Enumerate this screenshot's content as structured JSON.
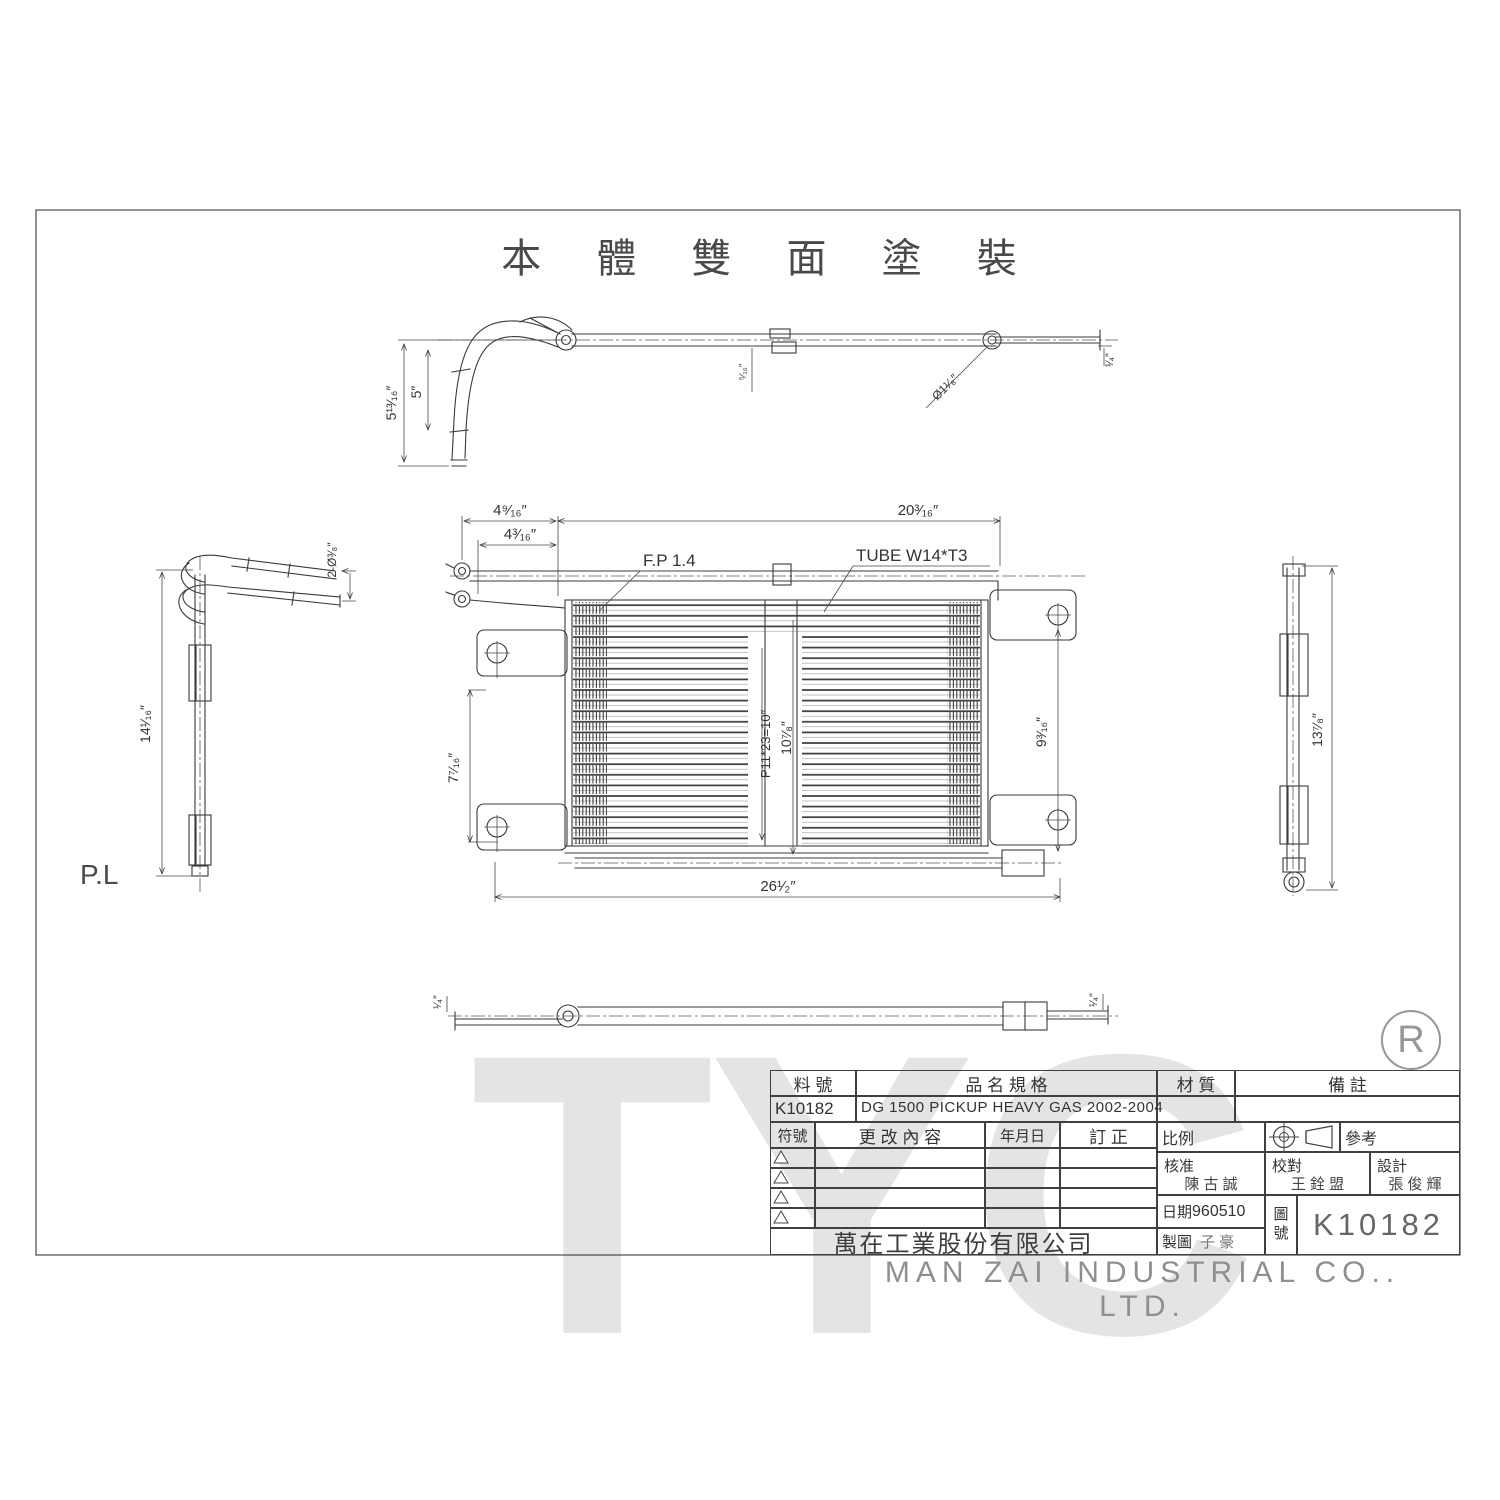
{
  "title": "本 體 雙 面 塗 裝",
  "watermark": "TYC",
  "registered": "R",
  "labels": {
    "pl": "P.L",
    "fin_pitch": "F.P 1.4",
    "tube_spec": "TUBE W14*T3"
  },
  "dims": {
    "top": {
      "overall_drop": "5¹³⁄₁₆″",
      "inner_drop": "5″",
      "clamp": "⁵⁄₁₆″",
      "hole": "Ø1¹⁄₈″",
      "tube_end": "¹⁄₄″"
    },
    "left": {
      "holes": "2-Ø³⁄₈″",
      "height": "14¹⁄₁₆″"
    },
    "front": {
      "offset_outer": "4⁹⁄₁₆″",
      "offset_inner": "4³⁄₁₆″",
      "core_width": "20³⁄₁₆″",
      "tube_pitch": "P11*23=10″",
      "core_height": "10⁷⁄₈″",
      "left_height": "7⁷⁄₁₆″",
      "right_height": "9³⁄₁₆″",
      "overall_width": "26¹⁄₂″"
    },
    "right": {
      "height": "13⁷⁄₈″"
    },
    "bottom": {
      "left_end": "¹⁄₄″",
      "right_end": "¹⁄₄″"
    }
  },
  "title_block": {
    "headers": {
      "part_no": "料 號",
      "name_spec": "品 名 規 格",
      "material": "材 質",
      "remarks": "備 註"
    },
    "part_no": "K10182",
    "spec": "DG 1500 PICKUP HEAVY GAS 2002-2004",
    "revision": {
      "symbol": "符號",
      "content": "更 改 內 容",
      "date": "年月日",
      "correction": "訂 正"
    },
    "scale_label": "比例",
    "reference_label": "參考",
    "approved_label": "核准",
    "approved_by": "陳 古 誠",
    "checked_label": "校對",
    "checked_by": "王 銓 盟",
    "designed_label": "設計",
    "designed_by": "張 俊 輝",
    "date_label": "日期",
    "date_value": "960510",
    "drawn_label": "製圖",
    "drawn_by": "子 豪",
    "drawing_no_label_top": "圖",
    "drawing_no_label_bottom": "號",
    "drawing_no": "K10182",
    "company_cn": "萬在工業股份有限公司",
    "company_en": "MAN ZAI INDUSTRIAL CO.. LTD."
  }
}
